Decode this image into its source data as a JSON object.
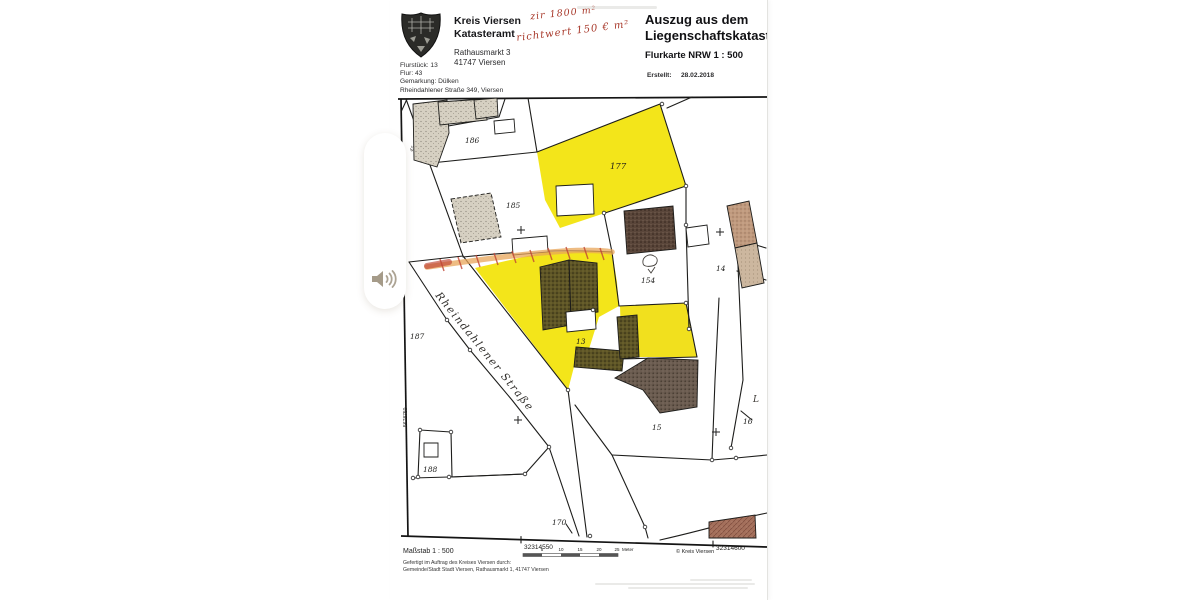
{
  "document": {
    "header": {
      "org_line1": "Kreis Viersen",
      "org_line2": "Katasteramt",
      "address_line1": "Rathausmarkt 3",
      "address_line2": "41747 Viersen",
      "handnote_line1": "zir 1800 m²",
      "handnote_line2": "richtwert 150 € m²",
      "title_line1": "Auszug aus dem",
      "title_line2": "Liegenschaftskataster",
      "subtitle": "Flurkarte NRW 1 : 500",
      "created_label": "Erstellt:",
      "created_value": "28.02.2018",
      "info_line1": "Flurstück: 13",
      "info_line2": "Flur: 43",
      "info_line3": "Gemarkung: Dülken",
      "info_line4": "Rheindahlener Straße 349, Viersen"
    },
    "map": {
      "street_name": "Rheindahlener Straße",
      "parcels": {
        "p186": "186",
        "p185": "185",
        "p177": "177",
        "p154": "154",
        "p14": "14",
        "p187": "187",
        "p13": "13",
        "p15": "15",
        "p16": "16",
        "p188": "188",
        "p170": "170"
      },
      "grid_left_top": "5678800",
      "grid_left_bottom": "5678750",
      "grid_bottom_left": "32314550",
      "grid_bottom_right": "32314600",
      "hand_mark": "L",
      "small_mark": "45"
    },
    "footer": {
      "scale_text": "Maßstab 1 : 500",
      "credit_line1": "Gefertigt im Auftrag des Kreises Viersen durch:",
      "credit_line2": "Gemeinde/Stadt Stadt Viersen, Rathausmarkt 1, 41747 Viersen",
      "copyright": "© Kreis Viersen",
      "scalebar": {
        "t1": "5",
        "t2": "10",
        "t3": "15",
        "t4": "20",
        "t5": "25",
        "unit": "Meter"
      }
    }
  },
  "overlay": {
    "audio_icon": "speaker-icon"
  },
  "colors": {
    "highlight_yellow": "#f2e40e",
    "crayon_orange": "#e8a55a",
    "crayon_red": "#c04434",
    "handwriting_red": "#a8392b",
    "building_olive": "#5e5526",
    "building_brown": "#5a463a",
    "building_gray": "#6b5c50",
    "building_tan": "#c09a7e",
    "building_stipple": "#d6d0c2",
    "building_redbrown": "#a4705c"
  }
}
